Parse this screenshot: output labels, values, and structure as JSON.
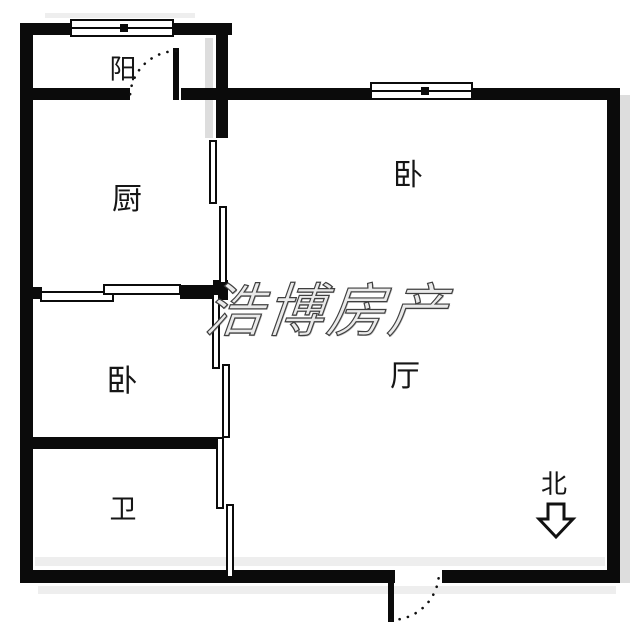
{
  "plan": {
    "title": "apartment-floor-plan",
    "watermark": "浩博房产",
    "rooms": {
      "balcony": {
        "label": "阳"
      },
      "kitchen": {
        "label": "厨"
      },
      "bedroom_top": {
        "label": "卧"
      },
      "bedroom_mid": {
        "label": "卧"
      },
      "living": {
        "label": "厅"
      },
      "bath": {
        "label": "卫"
      }
    },
    "compass": {
      "label": "北",
      "direction": "down"
    },
    "colors": {
      "wall": "#0b0b0b",
      "background": "#ffffff",
      "shadow": "#dddddd",
      "watermark_fill": "#eaeaea",
      "watermark_stroke": "#3f3f3f"
    }
  }
}
